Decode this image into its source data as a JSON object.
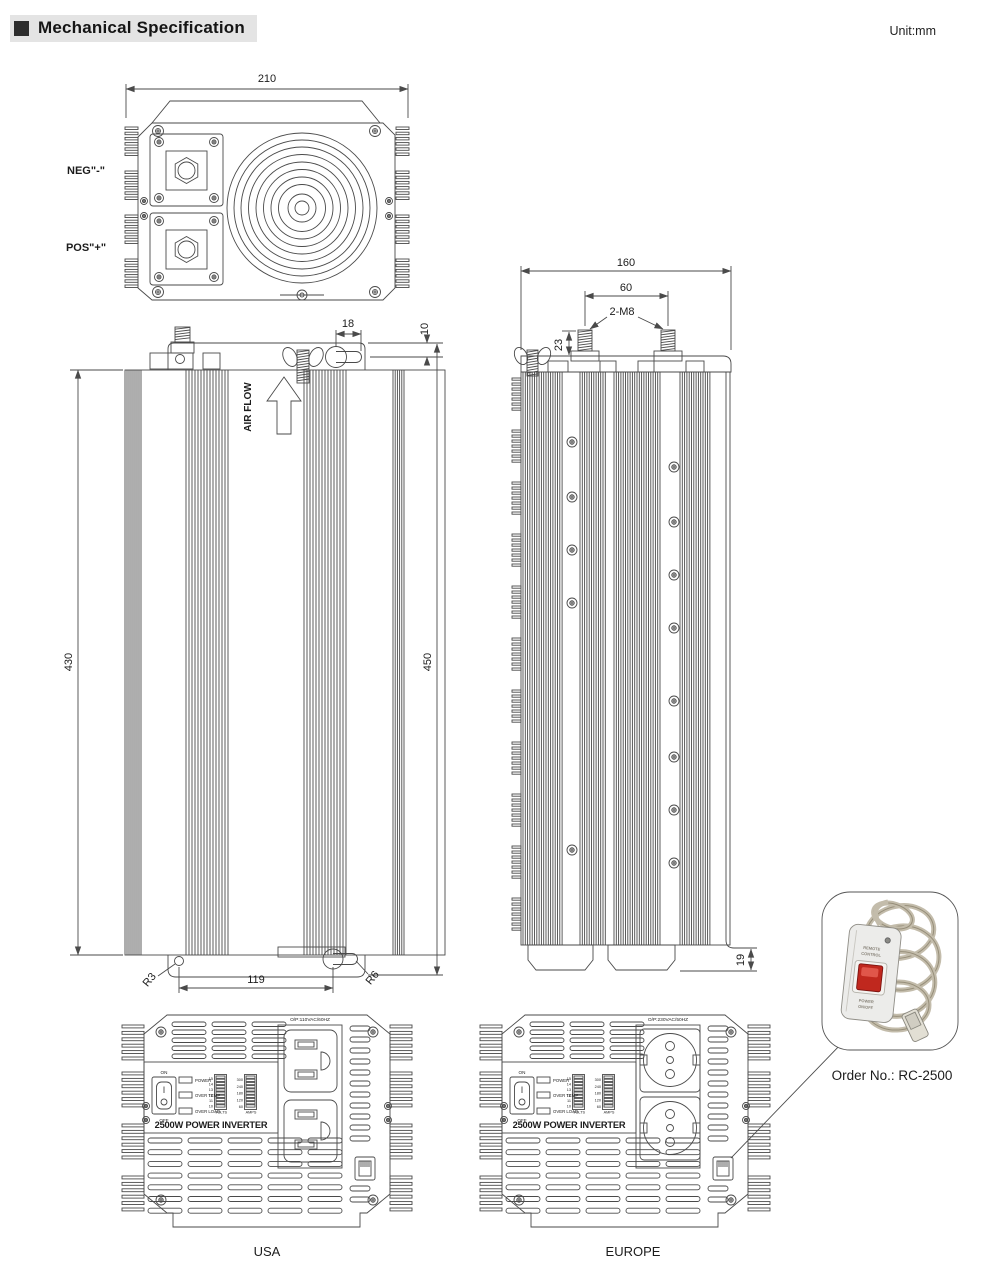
{
  "header": {
    "title": "Mechanical Specification",
    "unit": "Unit:mm"
  },
  "views": {
    "top": {
      "dim_width": "210",
      "neg_terminal": "NEG\"-\"",
      "pos_terminal": "POS\"+\""
    },
    "side": {
      "dim_body_height": "430",
      "dim_overall_height": "450",
      "dim_keyhole": "18",
      "dim_bracket_offset": "10",
      "airflow": "AIR FLOW",
      "dim_hole_span": "119",
      "radius_hole": "R3",
      "radius_keyhole": "R6"
    },
    "rear": {
      "dim_width": "160",
      "dim_stud_span": "60",
      "studs_label": "2-M8",
      "dim_stud_height": "23",
      "dim_foot_height": "19"
    }
  },
  "panel": {
    "switch_on": "ON",
    "switch_off": "OFF",
    "led_power": "POWER",
    "led_over_temp": "OVER TEMP",
    "led_over_load": "OVER LOAD",
    "volts_label": "VOLTS",
    "amps_label": "AMPS",
    "volts_ticks": [
      "15",
      "14",
      "13",
      "12",
      "11",
      "10"
    ],
    "amps_ticks": [
      "300",
      "240",
      "180",
      "120",
      "60"
    ],
    "product_name": "2500W POWER INVERTER"
  },
  "usa": {
    "output_label": "O/P:110VAC/60HZ",
    "caption": "USA"
  },
  "europe": {
    "output_label": "O/P:230VAC/50HZ",
    "caption": "EUROPE"
  },
  "remote": {
    "line1": "REMOTE",
    "line2": "CONTROL",
    "line3": "POWER",
    "line4": "ON/OFF",
    "order_no": "Order No.: RC-2500"
  },
  "colors": {
    "line": "#4a4a4a",
    "red_button": "#c0281e",
    "header_bg": "#e4e4e4"
  }
}
